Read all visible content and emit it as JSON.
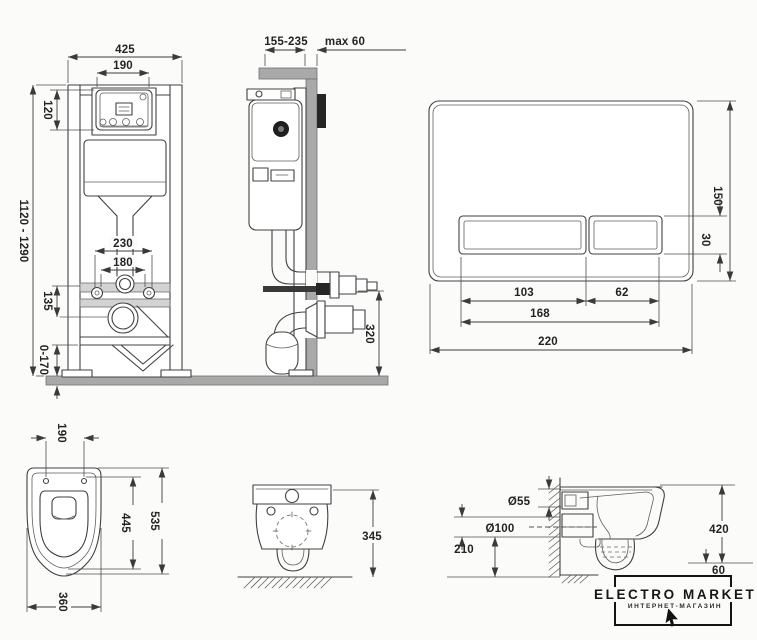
{
  "colors": {
    "background": "#fbfbfa",
    "line": "#3e3e3e",
    "wall_fill": "#a9a9a9",
    "bracket_fill": "#d3d3d3",
    "plate_dark": "#262626"
  },
  "frame_front": {
    "width": "425",
    "opening_width": "190",
    "panel_height": "120",
    "install_height": "1120 - 1290",
    "fixing_span": "230",
    "pipe_span": "180",
    "bracket_offset": "135",
    "foot_adjust": "0-170"
  },
  "frame_side": {
    "depth": "155-235",
    "wall_thickness": "max 60",
    "outlet_height": "320"
  },
  "flush_plate": {
    "height": "150",
    "button_height": "30",
    "large_button_width": "103",
    "small_button_width": "62",
    "buttons_width": "168",
    "width": "220"
  },
  "bowl_top": {
    "fixing_span": "190",
    "inner_length": "445",
    "length": "535",
    "width": "360"
  },
  "bowl_front": {
    "height": "345"
  },
  "bowl_side": {
    "inlet_diameter": "Ø55",
    "outlet_diameter": "Ø100",
    "outlet_height": "210",
    "height": "420",
    "floor_gap": "60"
  },
  "logo": {
    "title": "ELECTRO MARKET",
    "subtitle": "ИНТЕРНЕТ-МАГАЗИН"
  }
}
